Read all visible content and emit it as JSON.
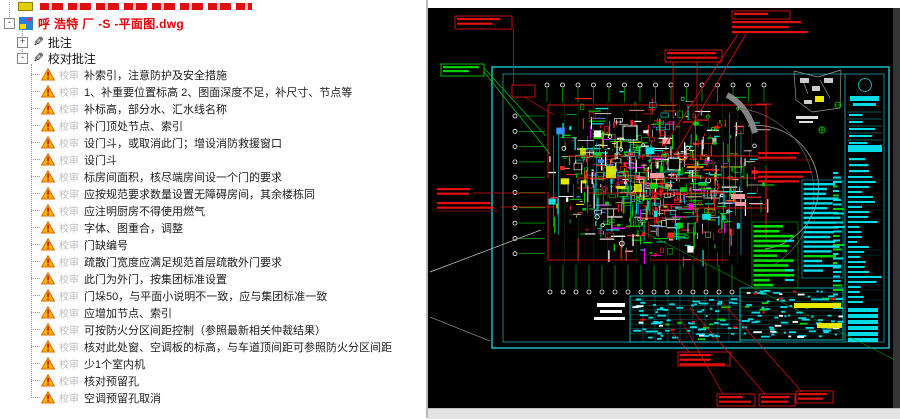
{
  "tree": {
    "file_name": "呼 浩特 厂 -S -平面图.dwg",
    "annotations_label": "批注",
    "review_label": "校对批注",
    "glyph_minus": "-",
    "glyph_plus": "+",
    "review_prefix": "校审",
    "review_items": [
      "补索引，注意防护及安全措施",
      "1、补重要位置标高 2、图面深度不足，补尺寸、节点等",
      "补标高，部分水、汇水线名称",
      "补门顶处节点、索引",
      "设门斗，或取消此门；增设消防救援窗口",
      "设门斗",
      "标房间面积，核尽端房间设一个门的要求",
      "应按规范要求数量设置无障碍房间，其余楼栋同",
      "应注明厨房不得使用燃气",
      "字体、图重合，调整",
      "门缺编号",
      "疏散门宽度应满足规范首层疏散外门要求",
      "此门为外门，按集团标准设置",
      "门垛50，与平面小说明不一致，应与集团标准一致",
      "应增加节点、索引",
      "可按防火分区间距控制（参照最新相关仲裁结果）",
      "核对此处窗、空调板的标高，与车道顶间距可参照防火分区间距",
      "少1个室内机",
      "核对预留孔",
      "空调预留孔取消"
    ]
  },
  "cad": {
    "palette": {
      "bg": "#000000",
      "frame": "#19bcc6",
      "table_cyan": "#00dce6",
      "green": "#00d000",
      "anno_red": "#e31010",
      "yellow": "#e8e800",
      "magenta": "#ff00ff",
      "white": "#ffffff",
      "gray": "#9a9a9a",
      "pink": "#ff9aa2"
    }
  },
  "ui": {
    "tree_red": "#e8000a",
    "warn_fill": "#ffb400",
    "warn_border": "#d86800"
  }
}
